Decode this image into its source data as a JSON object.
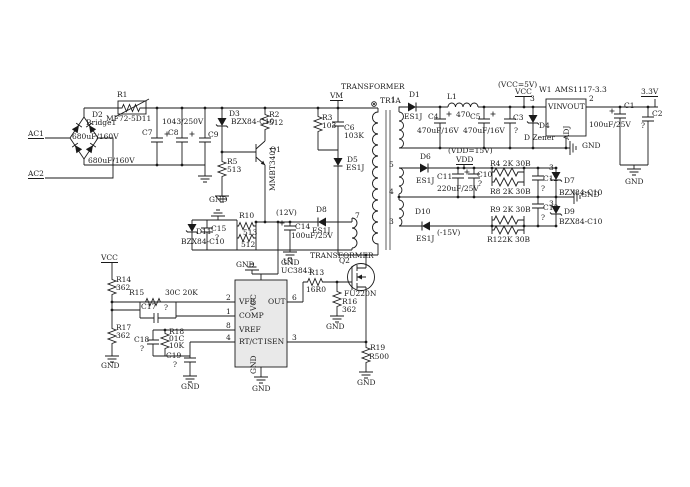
{
  "colors": {
    "ink": "#1a1a1a",
    "chip_fill": "#e9e9e9",
    "background": "#ffffff"
  },
  "s": {
    "input": {
      "ac1": "AC1",
      "ac2": "AC2",
      "d2": "D2",
      "d2v": "Bridge1",
      "r1": "R1",
      "r1v": "MF72-5D11",
      "c7": "C7",
      "c7v": "680uF/160V",
      "c8": "C8",
      "c8v": "680uF/160V",
      "c9": "C9",
      "c9v": "1043/250V"
    },
    "startup": {
      "d3": "D3",
      "d3v": "BZX84-C10",
      "r5": "R5",
      "r5v": "513",
      "r2": "R2",
      "r2v": "512",
      "q1": "Q1",
      "q1v": "MMBT3401"
    },
    "snubber": {
      "vm": "VM",
      "r3": "R3",
      "r3v": "103",
      "c6": "C6",
      "c6v": "103K",
      "d5": "D5",
      "d5v": "ES1J"
    },
    "xfmr": {
      "label1": "TRANSFORMER",
      "tr1a": "TR1A",
      "label2": "TRANSFORMER",
      "pin1": "1",
      "pin5": "5",
      "pin4": "4",
      "pin3": "3",
      "pin7": "7"
    },
    "out5": {
      "d1": "D1",
      "d1v": "ES1J",
      "l1": "L1",
      "l1v": "470",
      "c4": "C4",
      "c4v": "470uF/16V",
      "c5": "C5",
      "c5v": "470uF/16V",
      "c3": "C3",
      "c3q": "?",
      "d4": "D4",
      "d4v": "D Zener",
      "note": "(VCC=5V)",
      "vcc": "VCC",
      "p3": "3",
      "w1": "W1",
      "w1v": "AMS1117-3.3",
      "vin": "VIN",
      "vout": "VOUT",
      "adj": "ADJ",
      "p2": "2",
      "gnd_adj": "GND",
      "c1": "C1",
      "c1v": "100uF/25V",
      "c2": "C2",
      "c2q": "?",
      "v33": "3.3V",
      "gnd": "GND"
    },
    "out15": {
      "note": "(VDD=15V)",
      "vdd": "VDD",
      "d6": "D6",
      "d6v": "ES1J",
      "c11": "C11",
      "c11v": "220uF/25V",
      "c10": "C10",
      "c10q": "?",
      "r4": "R4 2K 30B",
      "r8": "R8 2K 30B",
      "c12": "C12",
      "c12q": "?",
      "d7p": "3",
      "d7": "D7",
      "d7v": "BZX84-C10",
      "gnd": "GND",
      "r9": "R9 2K 30B",
      "r12": "R122K 30B",
      "c13": "C13",
      "c13q": "?",
      "d9p": "3",
      "d9": "D9",
      "d9v": "BZX84-C10",
      "d10": "D10",
      "d10v": "ES1J",
      "neg": "(-15V)"
    },
    "aux": {
      "gnd": "GND",
      "d11": "D11",
      "d11v": "BZX84-C10",
      "c15": "C15",
      "c15q": "?",
      "r10": "R10",
      "r10v1": "513",
      "r10v2": "512",
      "v12": "(12V)",
      "c14": "C14",
      "c14v": "100uF/25V",
      "gnd_c14": "GND",
      "d8": "D8",
      "d8v": "ES1J"
    },
    "ctrl": {
      "u1": "U1",
      "u1v": "UC3843",
      "vfb": "VFB",
      "comp": "COMP",
      "vref": "VREF",
      "rtct": "RT/CT",
      "out": "OUT",
      "isen": "ISEN",
      "vcc": "VCC",
      "gnd": "GND",
      "p2": "2",
      "p1": "1",
      "p8": "8",
      "p4": "4",
      "p6": "6",
      "p3": "3",
      "gnd_top": "GND",
      "gnd_bot": "GND",
      "vcc_net": "VCC",
      "r14": "R14",
      "r14v": "362",
      "r15": "R15",
      "r15v": "30C 20K",
      "c17": "C17",
      "c17q": "?",
      "r17": "R17",
      "r17v": "362",
      "gnd_r17": "GND",
      "c18": "C18",
      "c18q": "?",
      "r18": "R18",
      "r18c": "01C",
      "r18v": "10K",
      "c19": "C19",
      "c19q": "?",
      "gnd_c19": "GND"
    },
    "sw": {
      "q2": "Q2",
      "q2v": "FU220N",
      "r13": "R13",
      "r13v": "16R0",
      "r16": "R16",
      "r16v": "362",
      "gnd_r16": "GND",
      "r19": "R19",
      "r19v": "R500",
      "gnd_r19": "GND"
    }
  }
}
